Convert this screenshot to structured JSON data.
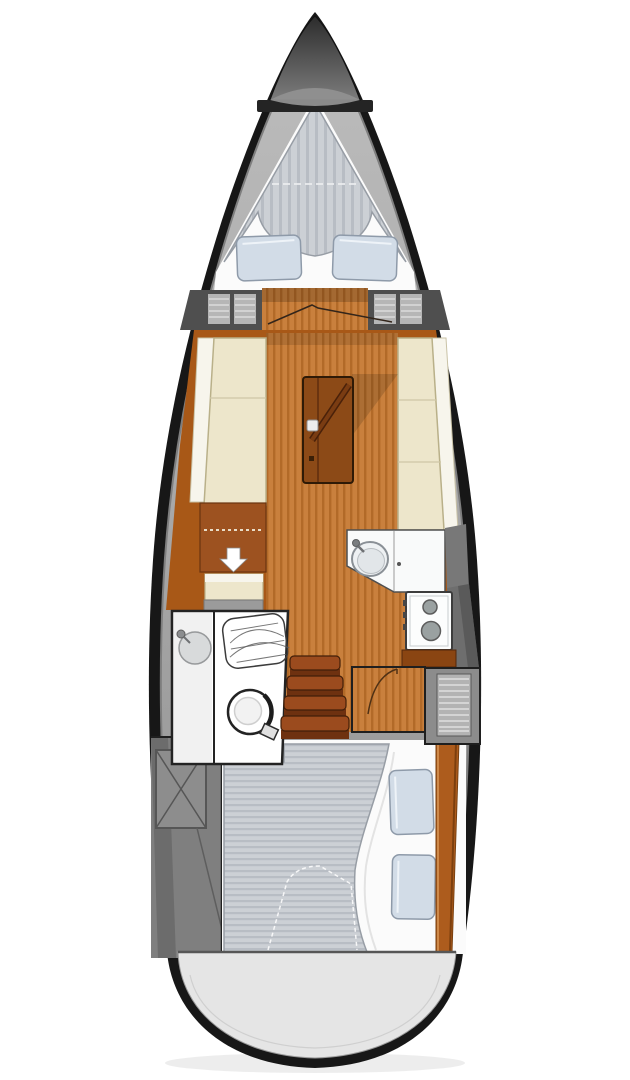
{
  "meta": {
    "title": "Sailboat interior floor plan (top-down deck layout, bow at top)",
    "diagram_type": "boat-floorplan"
  },
  "areas": {
    "bow": {
      "name": "anchor locker cap"
    },
    "forward_cabin": {
      "name": "V-berth double bed",
      "pillow_count": 2,
      "mattress_stripes": "vertical"
    },
    "forward_bulkhead": {
      "name": "slatted lockers with bi-fold door"
    },
    "saloon": {
      "name": "saloon",
      "port_side": "L-settee with chart table seat (down-arrow marker)",
      "starboard_side": "straight settee",
      "table": "centerline table with cup holder and diagonal strut"
    },
    "galley": {
      "name": "galley",
      "equipment": [
        "round sink with faucet",
        "cabinet door",
        "two-burner stove"
      ]
    },
    "head": {
      "name": "head compartment",
      "equipment": [
        "round washbasin",
        "folding shower screen",
        "marine toilet"
      ]
    },
    "companionway": {
      "name": "companionway steps",
      "step_count": 4
    },
    "aft_cabin": {
      "name": "aft double berth",
      "pillow_count": 2,
      "mattress_stripes": "horizontal"
    },
    "aft_port": {
      "name": "technical / cockpit locker space with crossed hatch"
    },
    "stern": {
      "name": "rounded transom"
    }
  },
  "colors": {
    "hull": "#171717",
    "deck_hi": "#bdbdbd",
    "deck_lo": "#8f8f8f",
    "transom": "#e5e5e5",
    "cap_dark": "#2c2c2c",
    "cap_mid": "#7c7c7c",
    "cap_band": "#909090",
    "bar_dark": "#242424",
    "berth_white": "#fbfbfb",
    "matt": "#ccd0d5",
    "matt_stripe": "#b8bdc4",
    "matt_edge": "#979da5",
    "pillow": "#d2dce7",
    "pillow_edge": "#8e9aa9",
    "locker_dark": "#4f4f4f",
    "slat_light": "#b6b6b6",
    "wood_side": "#a85817",
    "wood_dark": "#8a4512",
    "floor": "#c9803d",
    "floor_stripe": "#b26a28",
    "settee": "#ede6cb",
    "settee_white": "#f7f5ec",
    "settee_edge": "#b9b089",
    "cab_brown": "#9d5220",
    "cab_edge": "#6b3410",
    "table": "#8c4a17",
    "table_edge": "#2e1a06",
    "strut": "#7a3c12",
    "counter": "#f9fafa",
    "counter_edge": "#4f4f4f",
    "sink_fill": "#eef1f3",
    "sink_rim": "#8a9096",
    "stove_face": "#fcfdfd",
    "stove_edge": "#3d3d3d",
    "burner": "#9aa1a1",
    "burner_edge": "#5c5c5c",
    "knob": "#474747",
    "head_wall": "#f1f1f1",
    "fixture_gray": "#d8dadb",
    "fixture_rim": "#97999b",
    "toilet_edge": "#232323",
    "step": "#9b4b1e",
    "step_front": "#6e3110",
    "step_edge": "#421f09",
    "vent_gray": "#8c8c8c",
    "panel_gray": "#6e6e6e",
    "tech_gray": "#7f7f7f",
    "tech_dark": "#646464",
    "tech_line": "#565656",
    "divider": "#1f1f1f",
    "plank": "#ad5c1d",
    "plank_hi": "#cf8a4a",
    "plank_sh": "#7c3f0e",
    "white": "#ffffff",
    "arrow_white": "#ffffff",
    "dash_cream": "#e9ddc8"
  }
}
